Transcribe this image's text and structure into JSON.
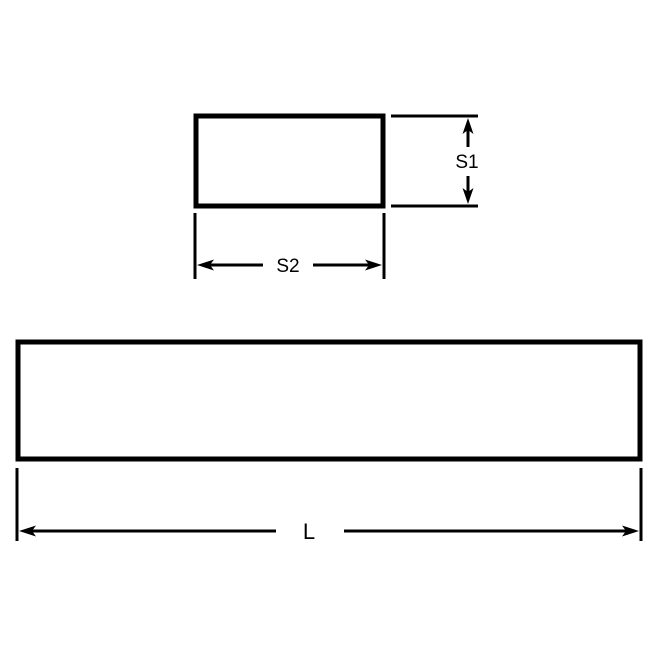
{
  "diagram": {
    "labels": {
      "s1": "S1",
      "s2": "S2",
      "l": "L"
    },
    "colors": {
      "line": "#000000",
      "background": "#ffffff"
    }
  }
}
